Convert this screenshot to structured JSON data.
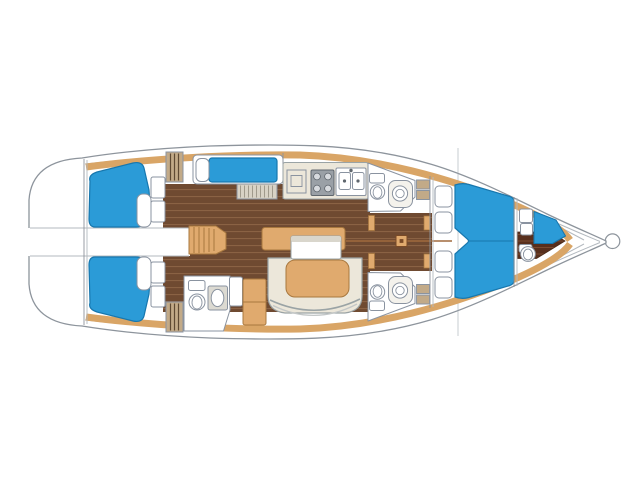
{
  "diagram": {
    "kind": "sailing-yacht-interior-floor-plan",
    "orientation": "bow-right",
    "rooms": [
      {
        "id": "transom-deck",
        "label": "stern deck"
      },
      {
        "id": "aft-cabin-port",
        "label": "aft double cabin with berth"
      },
      {
        "id": "aft-cabin-starboard",
        "label": "aft double cabin with berth"
      },
      {
        "id": "companionway",
        "label": "companionway steps"
      },
      {
        "id": "aft-head",
        "label": "aft head with toilet and basin"
      },
      {
        "id": "single-cabin",
        "label": "single berth cabin"
      },
      {
        "id": "galley",
        "label": "galley with icebox, stove and double sink"
      },
      {
        "id": "midship-head-top",
        "label": "head with toilet and washbasin"
      },
      {
        "id": "midship-head-bottom",
        "label": "head with toilet and washbasin"
      },
      {
        "id": "saloon",
        "label": "saloon with U-settee and table"
      },
      {
        "id": "mast-step",
        "label": "mast step"
      },
      {
        "id": "forward-cabin",
        "label": "forward V-berth cabin"
      },
      {
        "id": "bow-cabin",
        "label": "bow cabin with berth and toilet"
      },
      {
        "id": "bow-fitting",
        "label": "anchor fitting"
      }
    ]
  },
  "colors": {
    "background": "#ffffff",
    "white": "#ffffff",
    "hull_outline": "#8d949c",
    "deck_line": "#b3b9bf",
    "section_line": "#9aa4ad",
    "trim": "#d9a566",
    "trim_edge": "#a8783f",
    "berth": "#2b9bd7",
    "berth_edge": "#1777ae",
    "floor": "#6f4a31",
    "floor_line": "#8a6244",
    "floor_dark": "#582f1d",
    "floor_dark_line": "#7a4a30",
    "cream": "#ece7da",
    "cream_edge": "#9aa3a5",
    "cream_band": "#d9d6cc",
    "tan": "#e0aa6e",
    "fixture_edge": "#8a93a0",
    "locker": "#c2aa88",
    "locker_stripe": "#5f4a33",
    "dresser": "#d8d2c5",
    "dresser_stripe": "#a09a8c",
    "stove": "#9aa0a6",
    "stove_detail": "#5f666d"
  }
}
